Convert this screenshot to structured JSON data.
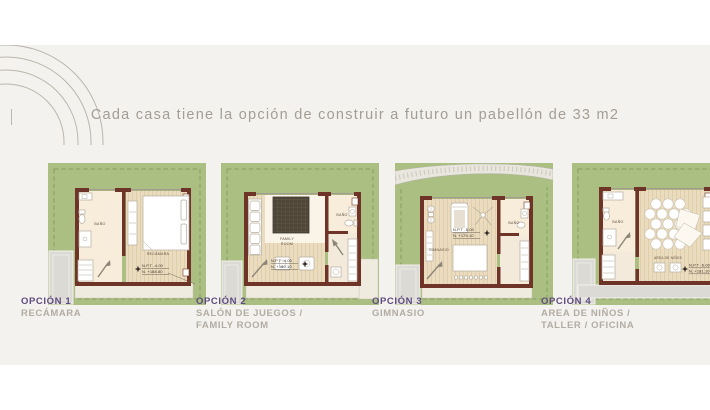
{
  "page": {
    "title": "Cada casa tiene la opción de construir a futuro un pabellón de 33 m2"
  },
  "colors": {
    "accent_purple": "#5e4b80",
    "sage_green": "#aabf81",
    "wall_brown": "#6f3428",
    "band_gray": "#f3f2ee",
    "caption_gray": "#b2aca3"
  },
  "options": [
    {
      "name": "OPCIÓN 1",
      "subtitle_lines": [
        "RECÁMARA"
      ],
      "labels": {
        "bath": "BAÑO",
        "main": [
          "RECÁMARA"
        ]
      },
      "npt": "N.P.T -4.00",
      "level": "N. +188.80"
    },
    {
      "name": "OPCIÓN 2",
      "subtitle_lines": [
        "SALÓN DE JUEGOS /",
        "FAMILY ROOM"
      ],
      "labels": {
        "bath": "BAÑO",
        "main": [
          "FAMILY",
          "ROOM"
        ]
      },
      "npt": "N.P.T -4.00",
      "level": "N. +180.10"
    },
    {
      "name": "OPCIÓN 3",
      "subtitle_lines": [
        "GIMNASIO"
      ],
      "labels": {
        "bath": "BAÑO",
        "main": [
          "GIMNASIO"
        ]
      },
      "npt": "N.P.T -5.00",
      "level": "N. +179.10"
    },
    {
      "name": "OPCIÓN 4",
      "subtitle_lines": [
        "AREA DE NIÑOS /",
        "TALLER / OFICINA"
      ],
      "labels": {
        "bath": "BAÑO",
        "main": [
          "AREA DE NIÑOS"
        ]
      },
      "npt": "N.P.T -6.00",
      "level": "N. +181.10"
    }
  ]
}
